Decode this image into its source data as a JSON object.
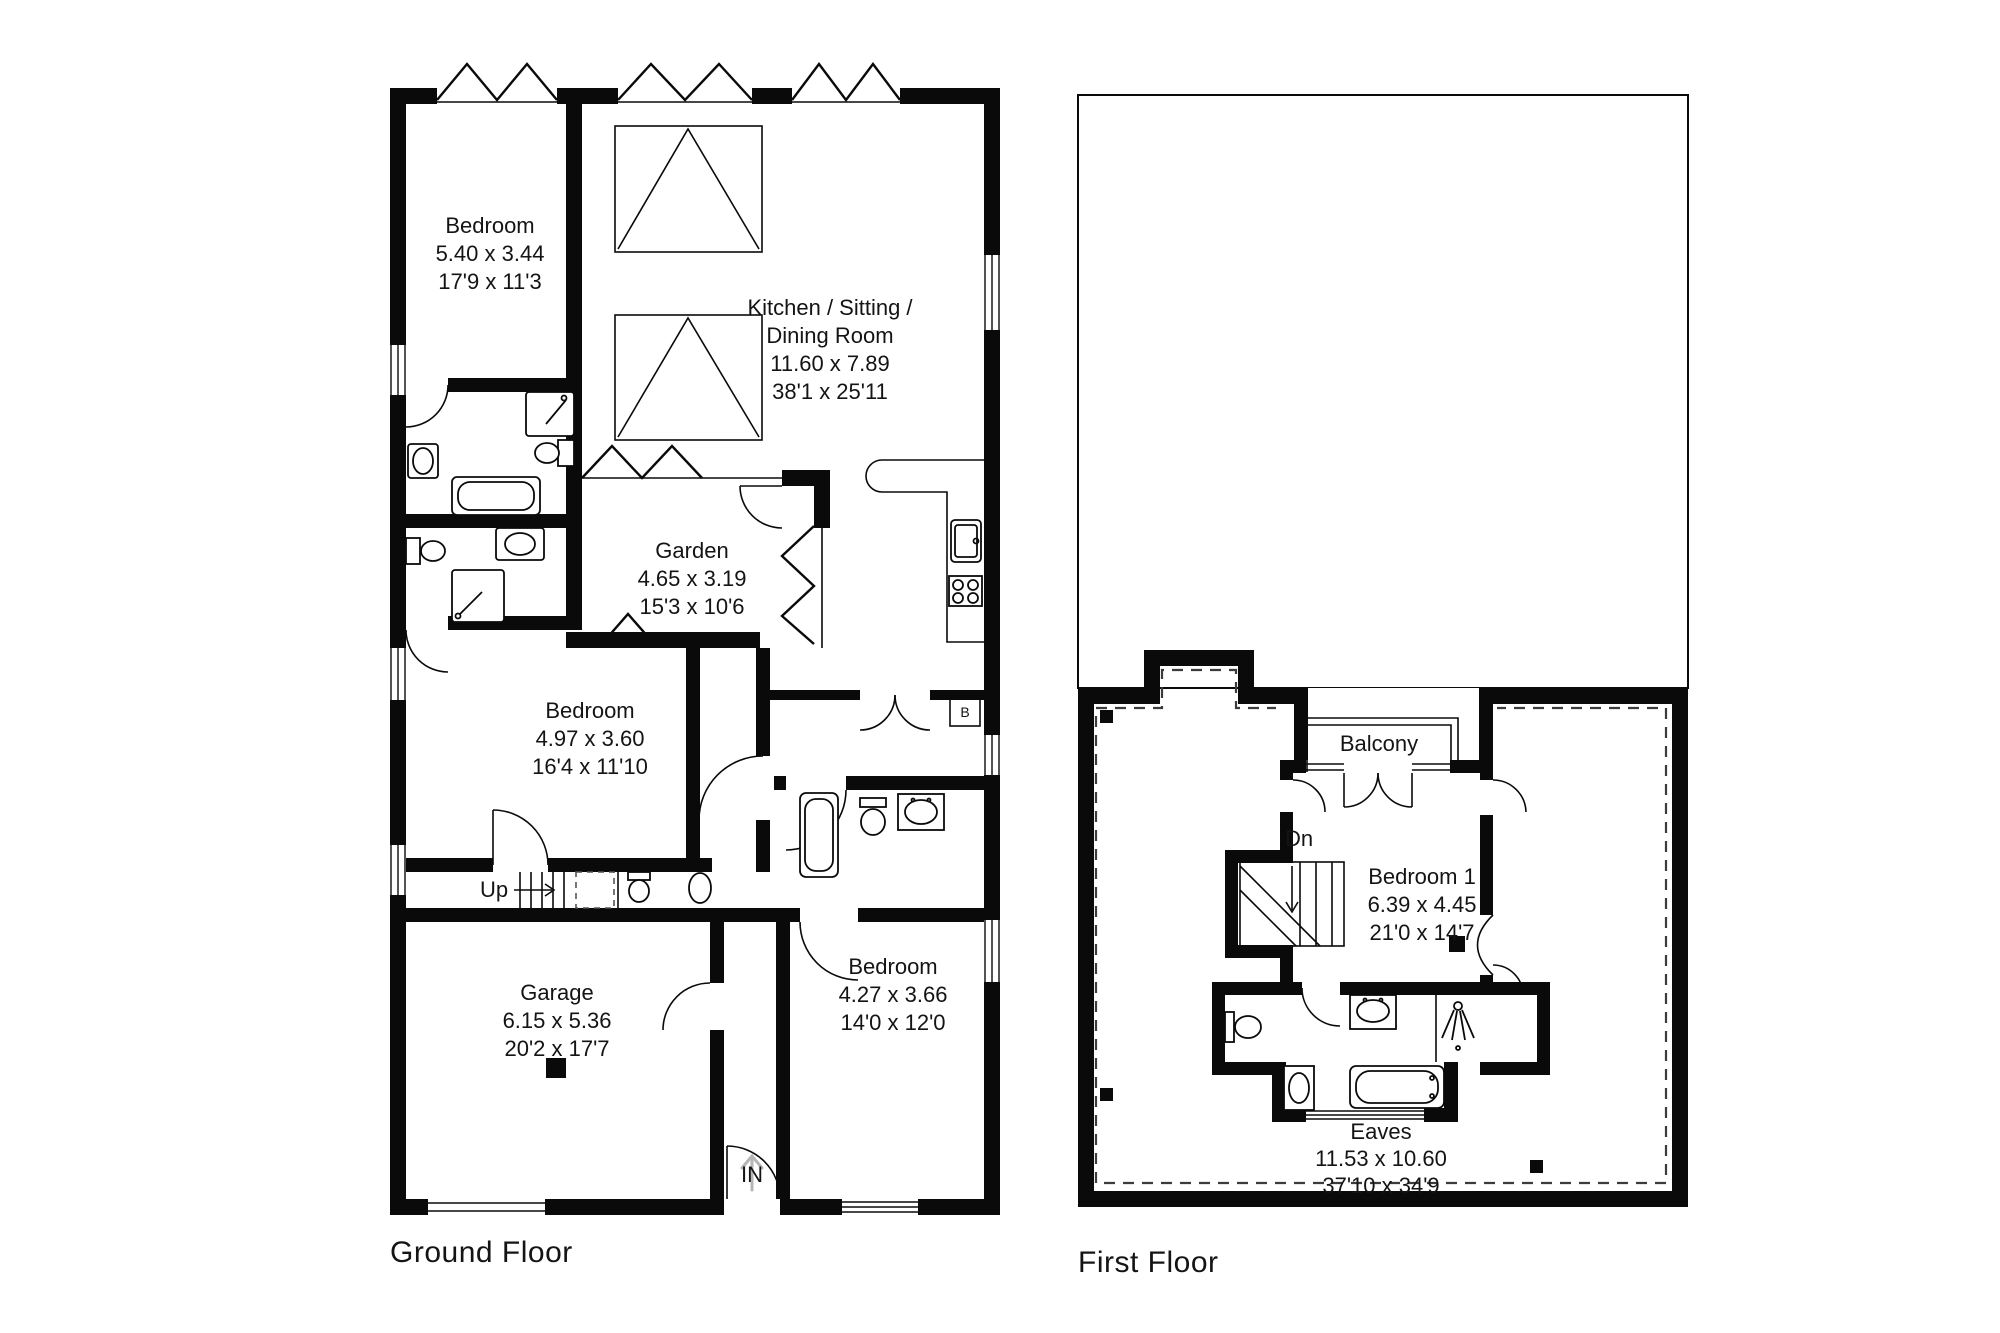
{
  "colors": {
    "wall": "#0a0a0a",
    "background": "#ffffff",
    "eaves_dashed": "#3c3c3c",
    "entrance_arrow": "#b5b5b5"
  },
  "ground_floor": {
    "label": "Ground Floor",
    "rooms": {
      "bedroom_top": {
        "name": "Bedroom",
        "metric": "5.40 x 3.44",
        "imperial": "17'9 x 11'3"
      },
      "kitchen": {
        "name1": "Kitchen / Sitting /",
        "name2": "Dining Room",
        "metric": "11.60 x 7.89",
        "imperial": "38'1 x 25'11"
      },
      "garden": {
        "name": "Garden",
        "metric": "4.65 x 3.19",
        "imperial": "15'3 x 10'6"
      },
      "bedroom_middle": {
        "name": "Bedroom",
        "metric": "4.97 x 3.60",
        "imperial": "16'4 x 11'10"
      },
      "garage": {
        "name": "Garage",
        "metric": "6.15 x 5.36",
        "imperial": "20'2 x 17'7"
      },
      "bedroom_right": {
        "name": "Bedroom",
        "metric": "4.27 x 3.66",
        "imperial": "14'0 x 12'0"
      }
    },
    "annotations": {
      "up": "Up",
      "entrance": "IN",
      "boiler": "B"
    }
  },
  "first_floor": {
    "label": "First Floor",
    "rooms": {
      "bedroom1": {
        "name": "Bedroom 1",
        "metric": "6.39 x 4.45",
        "imperial": "21'0 x 14'7"
      },
      "balcony": {
        "name": "Balcony"
      },
      "eaves": {
        "name": "Eaves",
        "metric": "11.53 x 10.60",
        "imperial": "37'10 x 34'9"
      }
    },
    "annotations": {
      "down": "Dn"
    }
  }
}
